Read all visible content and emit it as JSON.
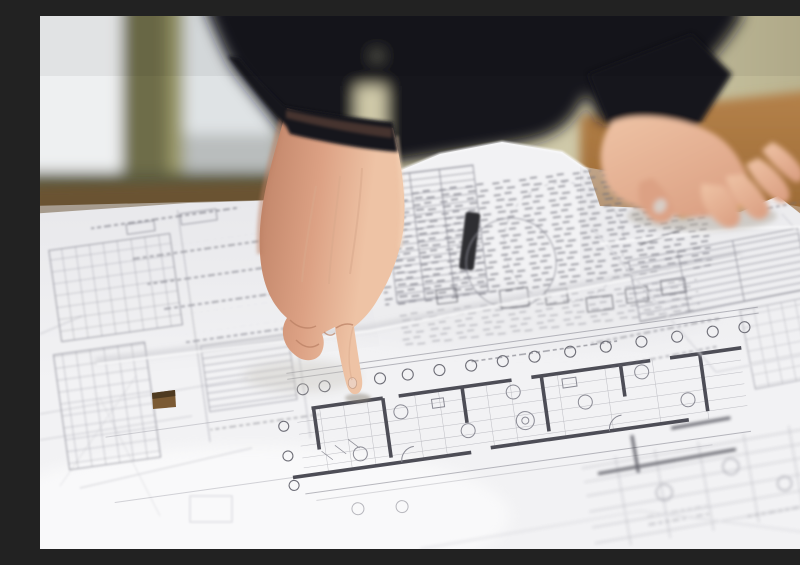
{
  "scene": {
    "description": "Close-up photograph: a person in a dark jacket points with an index finger at architectural floor-plan blueprints spread over a wooden table; the other hand rests flat on the sheets beside a yellow scale ruler; a blurred window and olive wall fill the background.",
    "objects": [
      {
        "id": "window",
        "label": "blurred window with olive frame"
      },
      {
        "id": "wall",
        "label": "olive-tan wall"
      },
      {
        "id": "wooden-table",
        "label": "wooden table surface"
      },
      {
        "id": "person-torso",
        "label": "person wearing dark jacket"
      },
      {
        "id": "pointing-hand",
        "label": "right hand pointing down"
      },
      {
        "id": "index-finger",
        "label": "extended index finger touching drawing"
      },
      {
        "id": "resting-hand",
        "label": "left hand resting on sheets"
      },
      {
        "id": "scale-ruler",
        "label": "yellow scale ruler under hand"
      },
      {
        "id": "blueprint-sheet-left",
        "label": "schedule tables sheet"
      },
      {
        "id": "blueprint-sheet-site-plan",
        "label": "tilted site plan sheet with black bar"
      },
      {
        "id": "blueprint-sheet-floor-plan",
        "label": "floor plan sheet with grid bubbles"
      },
      {
        "id": "blueprint-sheet-right",
        "label": "right overlapping sheets"
      },
      {
        "id": "punch-hole",
        "label": "punched square hole showing table"
      }
    ]
  },
  "colors": {
    "wall": "#b2ab88",
    "wall-light": "#d2cdab",
    "glass": "#dfe3e5",
    "glass-bright": "#eef0f1",
    "frame": "#6e6d4a",
    "frame-light": "#9a9868",
    "sill": "#5c5b40",
    "jacket": "#17171c",
    "jacket-light": "#2a2a32",
    "wood": "#b5824a",
    "wood-dark": "#875624",
    "wood-strip": "#6b5330",
    "paper": "#f2f2f4",
    "paper-dim": "#e0e0e4",
    "line": "#8a8a94",
    "line-dark": "#4d4d56",
    "scrib": "#70707a",
    "skin": "#eec3a5",
    "skin-mid": "#dca184",
    "skin-shadow": "#bd8165",
    "nail": "#ecd0c0",
    "ruler": "#d9a43c",
    "hole": "#7b5a33"
  }
}
